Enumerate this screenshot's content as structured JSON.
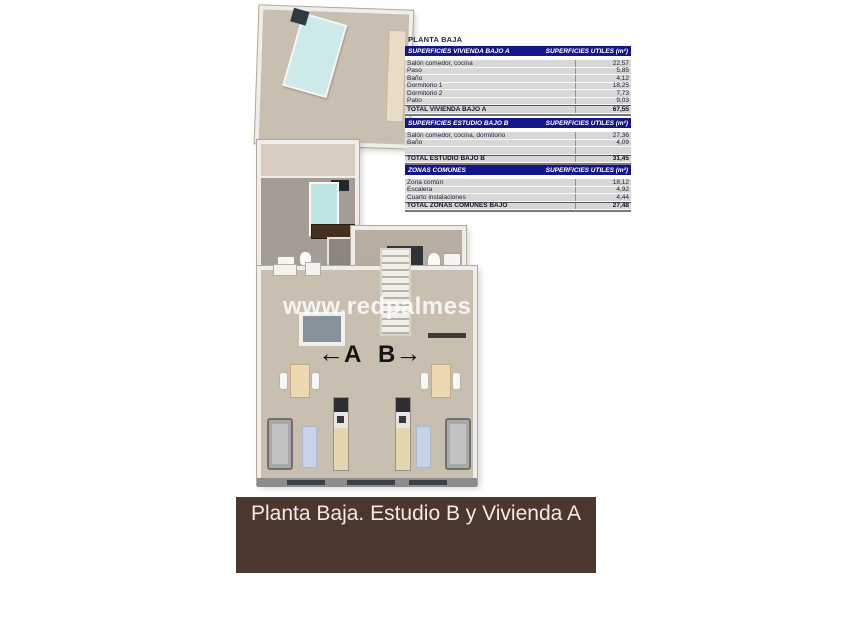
{
  "title": "PLANTA BAJA",
  "watermark": "www.redpalmes",
  "floorplan": {
    "unit_a_label": "A",
    "unit_b_label": "B",
    "arrow_left": "←",
    "arrow_right": "→"
  },
  "tables": [
    {
      "header_left": "SUPERFICIES VIVIENDA BAJO A",
      "header_right": "SUPERFICIES UTILES  (m²)",
      "rows": [
        {
          "label": "Salón comedor, cocina",
          "value": "22,57"
        },
        {
          "label": "Paso",
          "value": "5,85"
        },
        {
          "label": "Baño",
          "value": "4,12"
        },
        {
          "label": "Dormitorio 1",
          "value": "18,25"
        },
        {
          "label": "Dormitorio 2",
          "value": "7,73"
        },
        {
          "label": "Patio",
          "value": "9,03"
        }
      ],
      "total": {
        "label": "TOTAL VIVIENDA BAJO A",
        "value": "67,55"
      }
    },
    {
      "header_left": "SUPERFICIES ESTUDIO BAJO B",
      "header_right": "SUPERFICIES UTILES  (m²)",
      "rows": [
        {
          "label": "Salón comedor, cocina, dormitorio",
          "value": "27,36"
        },
        {
          "label": "Baño",
          "value": "4,09"
        }
      ],
      "total": {
        "label": "TOTAL ESTUDIO BAJO B",
        "value": "31,45"
      }
    },
    {
      "header_left": "ZONAS COMUNES",
      "header_right": "SUPERFICIES UTILES  (m²)",
      "rows": [
        {
          "label": "Zona común",
          "value": "18,12"
        },
        {
          "label": "Escalera",
          "value": "4,92"
        },
        {
          "label": "Cuarto instalaciones",
          "value": "4,44"
        }
      ],
      "total": {
        "label": "TOTAL ZONAS COMUNES BAJO",
        "value": "27,48"
      }
    }
  ],
  "banner": {
    "text": "Planta Baja. Estudio B y Vivienda A"
  },
  "colors": {
    "table_header_bg": "#15158a",
    "banner_bg": "#4a372e",
    "floor_tan": "#c9bfb1",
    "floor_gray": "#a39d96",
    "patio_gray": "#87919a",
    "bed_teal": "#c8e6e6",
    "rug_blue": "#c6d3e8"
  }
}
